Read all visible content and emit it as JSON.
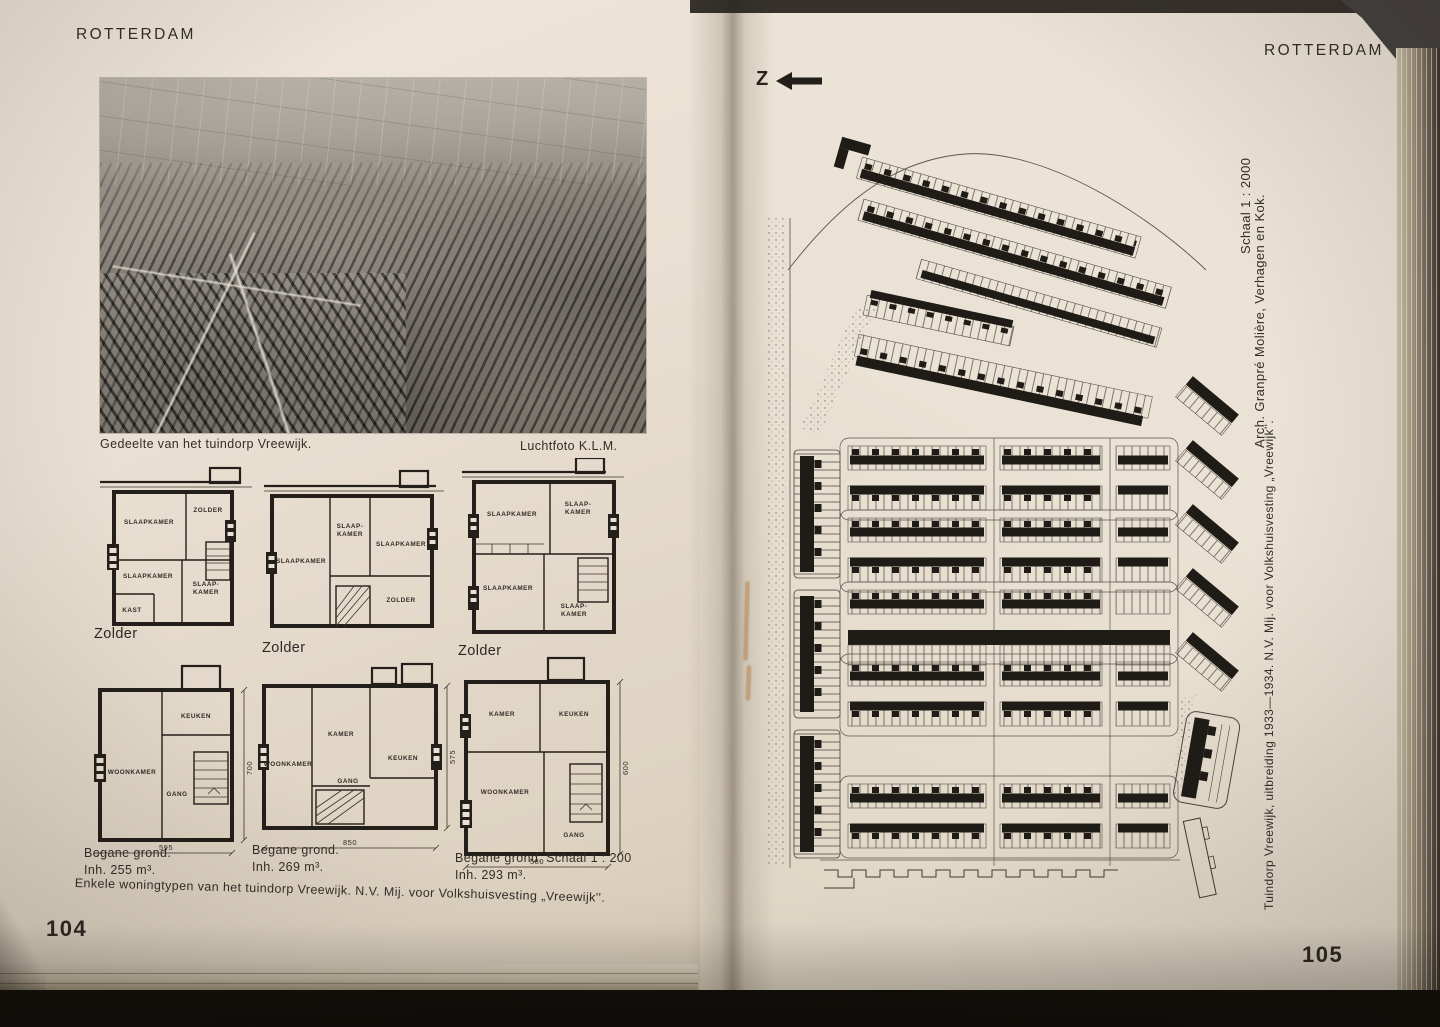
{
  "left_page": {
    "header": "ROTTERDAM",
    "page_number": "104",
    "photo_caption": "Gedeelte van het tuindorp Vreewijk.",
    "photo_credit": "Luchtfoto K.L.M.",
    "zolder_labels": {
      "z1": "Zolder",
      "z2": "Zolder",
      "z3": "Zolder"
    },
    "plans": {
      "p1": {
        "r1": "SLAAPKAMER",
        "r2": "ZOLDER",
        "r3": "SLAAPKAMER",
        "r4a": "SLAAP-",
        "r4b": "KAMER",
        "r5": "KAST"
      },
      "p2": {
        "r1": "SLAAPKAMER",
        "r2a": "SLAAP-",
        "r2b": "KAMER",
        "r3": "SLAAPKAMER",
        "r4": "ZOLDER"
      },
      "p3": {
        "r1": "SLAAPKAMER",
        "r2a": "SLAAP-",
        "r2b": "KAMER",
        "r3": "SLAAPKAMER",
        "r4a": "SLAAP-",
        "r4b": "KAMER"
      },
      "p4": {
        "keuken": "KEUKEN",
        "woonkamer": "WOONKAMER",
        "gang": "GANG",
        "width_dim": "595",
        "height_dim": "700"
      },
      "p5": {
        "woonkamer": "WOONKAMER",
        "kamer": "KAMER",
        "keuken": "KEUKEN",
        "gang": "GANG",
        "width_dim": "850",
        "height_dim": "575"
      },
      "p6": {
        "kamer": "KAMER",
        "keuken": "KEUKEN",
        "woonkamer": "WOONKAMER",
        "gang": "GANG",
        "width_dim": "580",
        "height_dim": "600"
      }
    },
    "ground_captions": {
      "c1a": "Begane grond.",
      "c1b": "Inh. 255 m³.",
      "c2a": "Begane grond.",
      "c2b": "Inh. 269 m³.",
      "c3a": "Begane grond.  Schaal 1 : 200",
      "c3b": "Inh. 293 m³."
    },
    "bottom_caption": "Enkele woningtypen van het tuindorp Vreewijk. N.V. Mij. voor Volkshuisvesting „Vreewijk''."
  },
  "right_page": {
    "header": "ROTTERDAM",
    "page_number": "105",
    "north_label": "Z",
    "rotated_captions": {
      "scale": "Schaal 1 : 2000",
      "architect": "Arch. Granpré Molière, Verhagen en Kok.",
      "title": "Tuindorp Vreewijk, uitbreiding 1933—1934.  N.V. Mij. voor Volkshuisvesting „Vreewijk''."
    }
  },
  "colors": {
    "paper": "#e9e1d3",
    "ink": "#2b2621",
    "background": "#17130f",
    "thread": "#c79f72"
  }
}
